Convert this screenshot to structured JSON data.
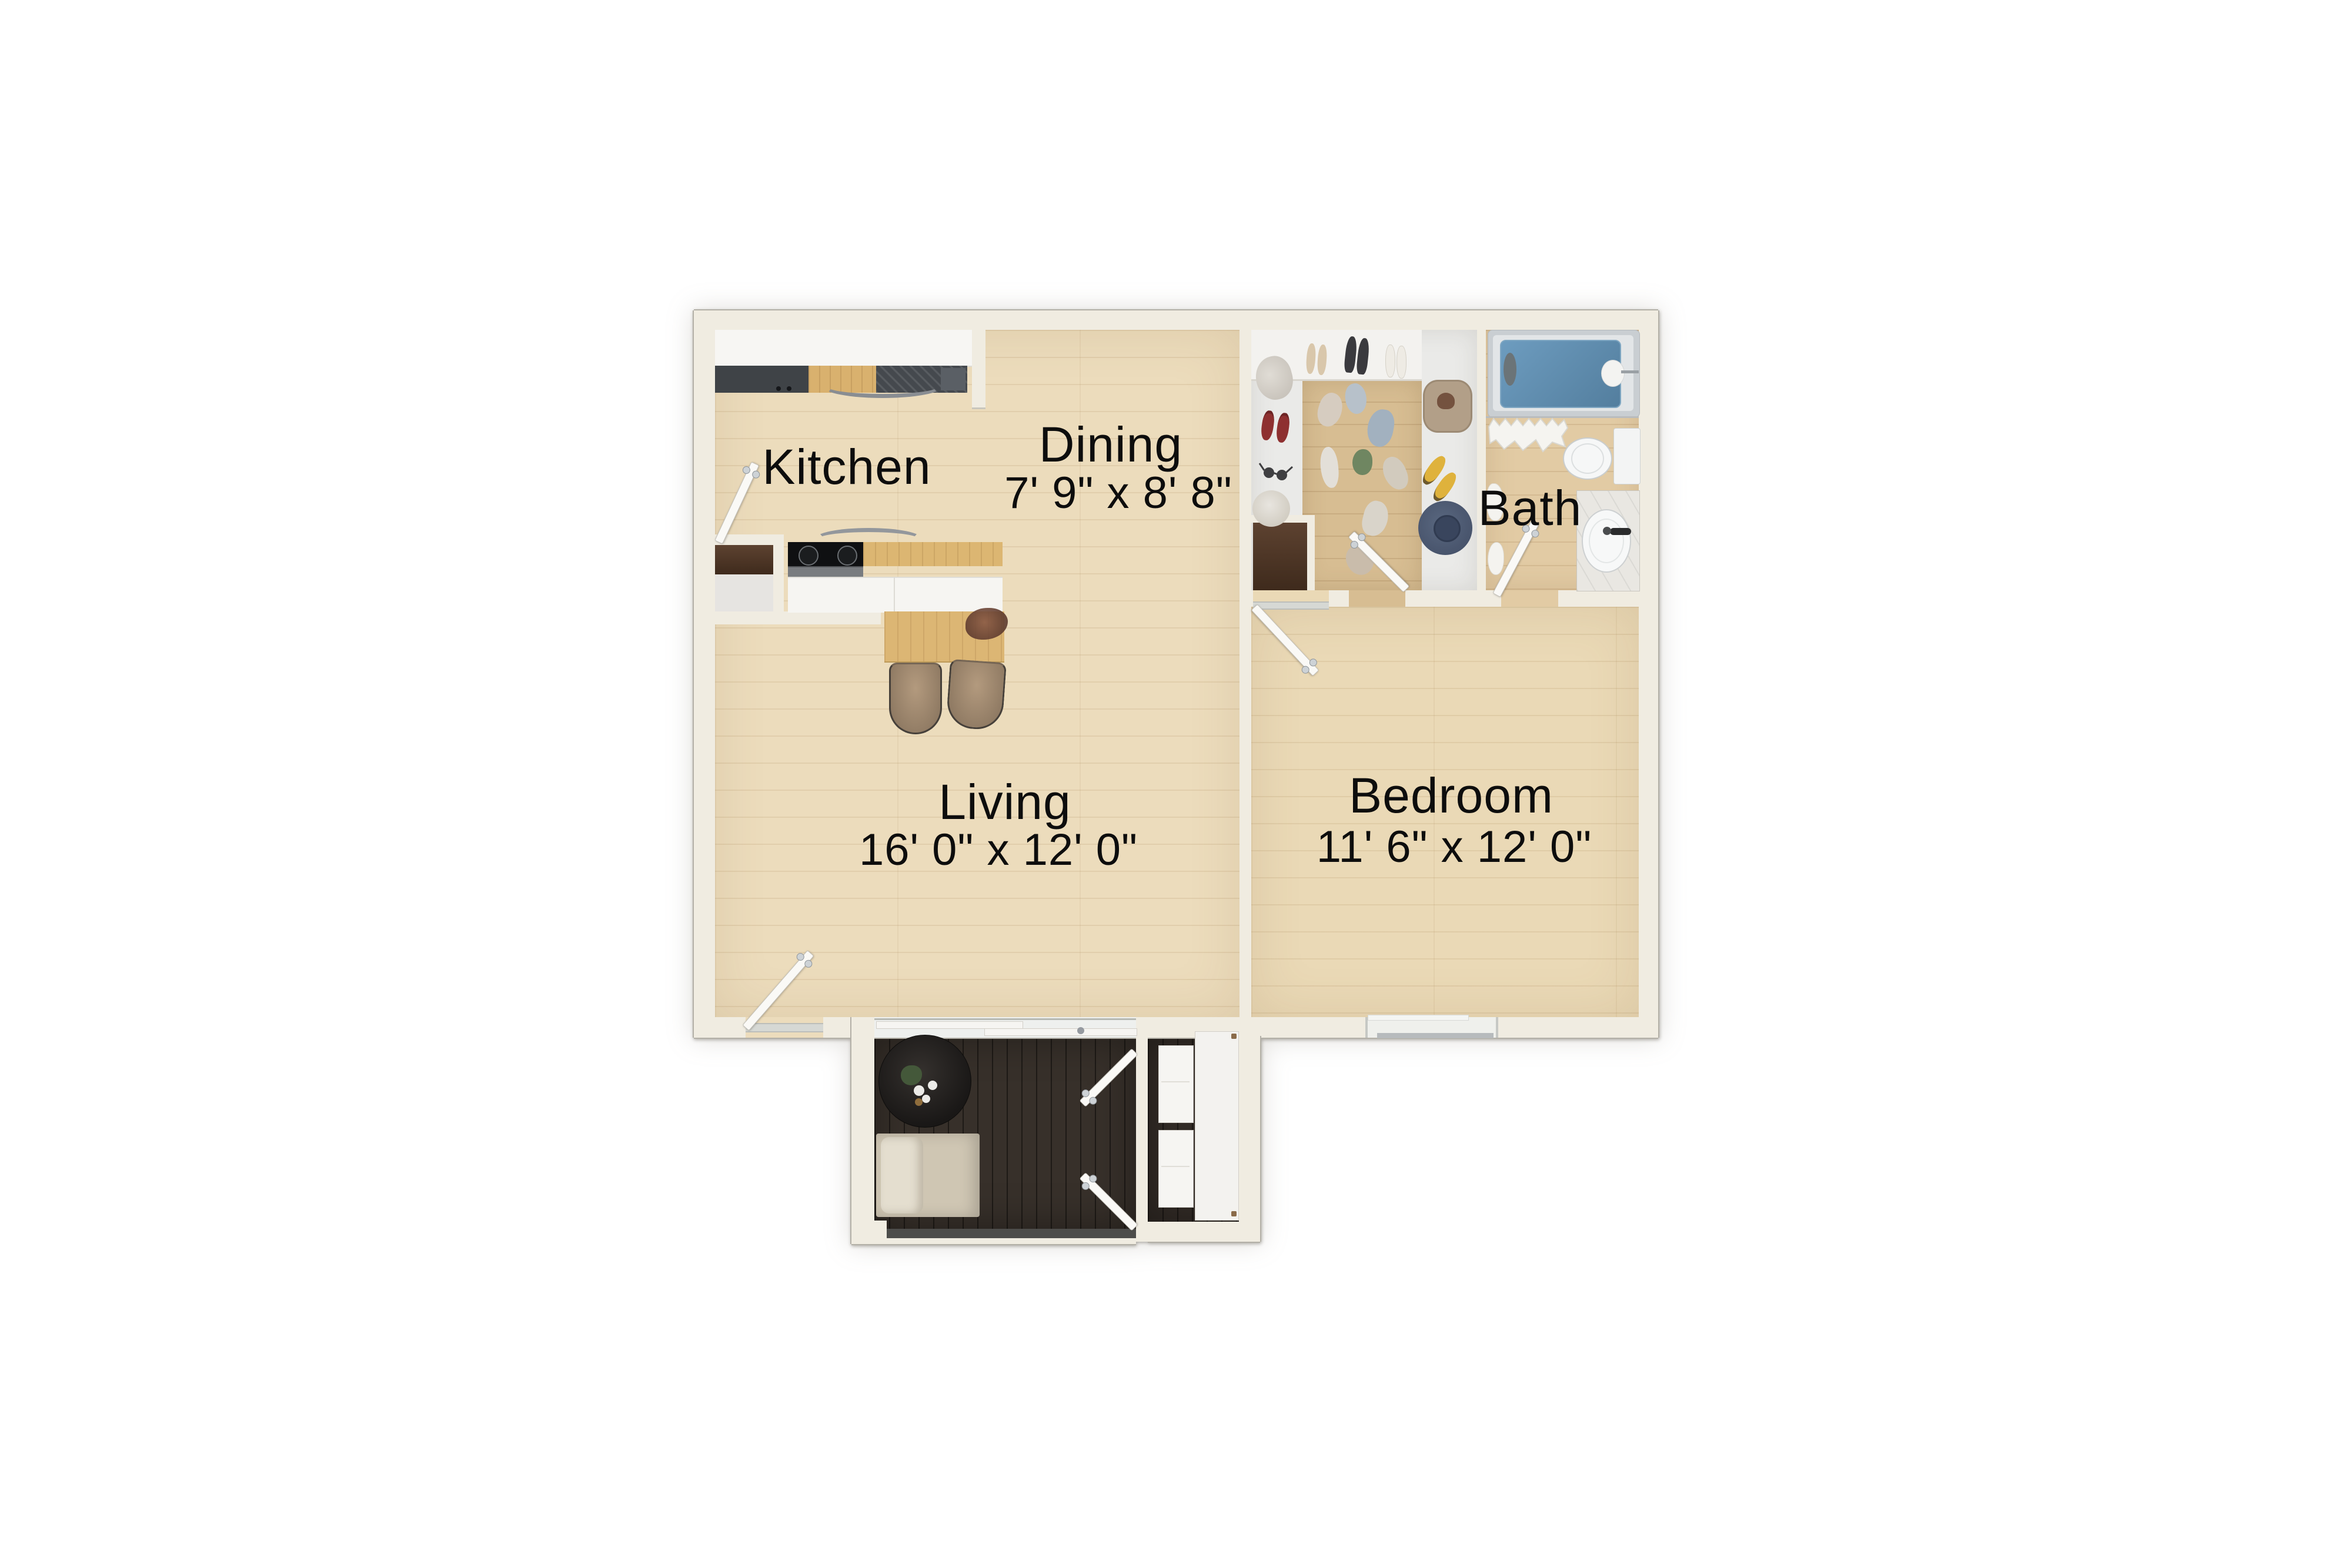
{
  "page_title": "One-bedroom apartment floor plan",
  "rooms": {
    "kitchen": {
      "name": "Kitchen",
      "dims": ""
    },
    "dining": {
      "name": "Dining",
      "dims": "7' 9\" x 8' 8\""
    },
    "bath": {
      "name": "Bath",
      "dims": ""
    },
    "living": {
      "name": "Living",
      "dims": "16' 0\" x 12' 0\""
    },
    "bedroom": {
      "name": "Bedroom",
      "dims": "11' 6\" x 12' 0\""
    }
  },
  "fixtures": [
    "bathtub",
    "shower-curtain",
    "toilet",
    "sink-vanity",
    "towels",
    "kitchen-counter",
    "cooktop-stove",
    "vent-appliance",
    "pantry-closet",
    "dining-table",
    "dining-chairs",
    "table-plant",
    "walk-in-closet",
    "wardrobe-shelf",
    "clothes",
    "shoes",
    "hat",
    "basket",
    "reach-in-closet",
    "bedroom-window",
    "entry-door",
    "bedroom-door",
    "closet-door",
    "bath-door",
    "sliding-patio-door",
    "patio-deck",
    "patio-round-table",
    "patio-bench",
    "patio-french-doors",
    "storage-closet",
    "storage-shelves",
    "storage-door"
  ],
  "colors": {
    "background": "#ffffff",
    "wall": "#f0ece1",
    "wood_floor": "#ecdcbc",
    "closet_wood": "#d7bd92",
    "bath_floor": "#e2cba4",
    "deck": "#37302a",
    "tub_water": "#5d8fb4",
    "counter_wood": "#dcb672",
    "fixture_white": "#f6f5f2",
    "label_text": "#0d0d0d"
  }
}
